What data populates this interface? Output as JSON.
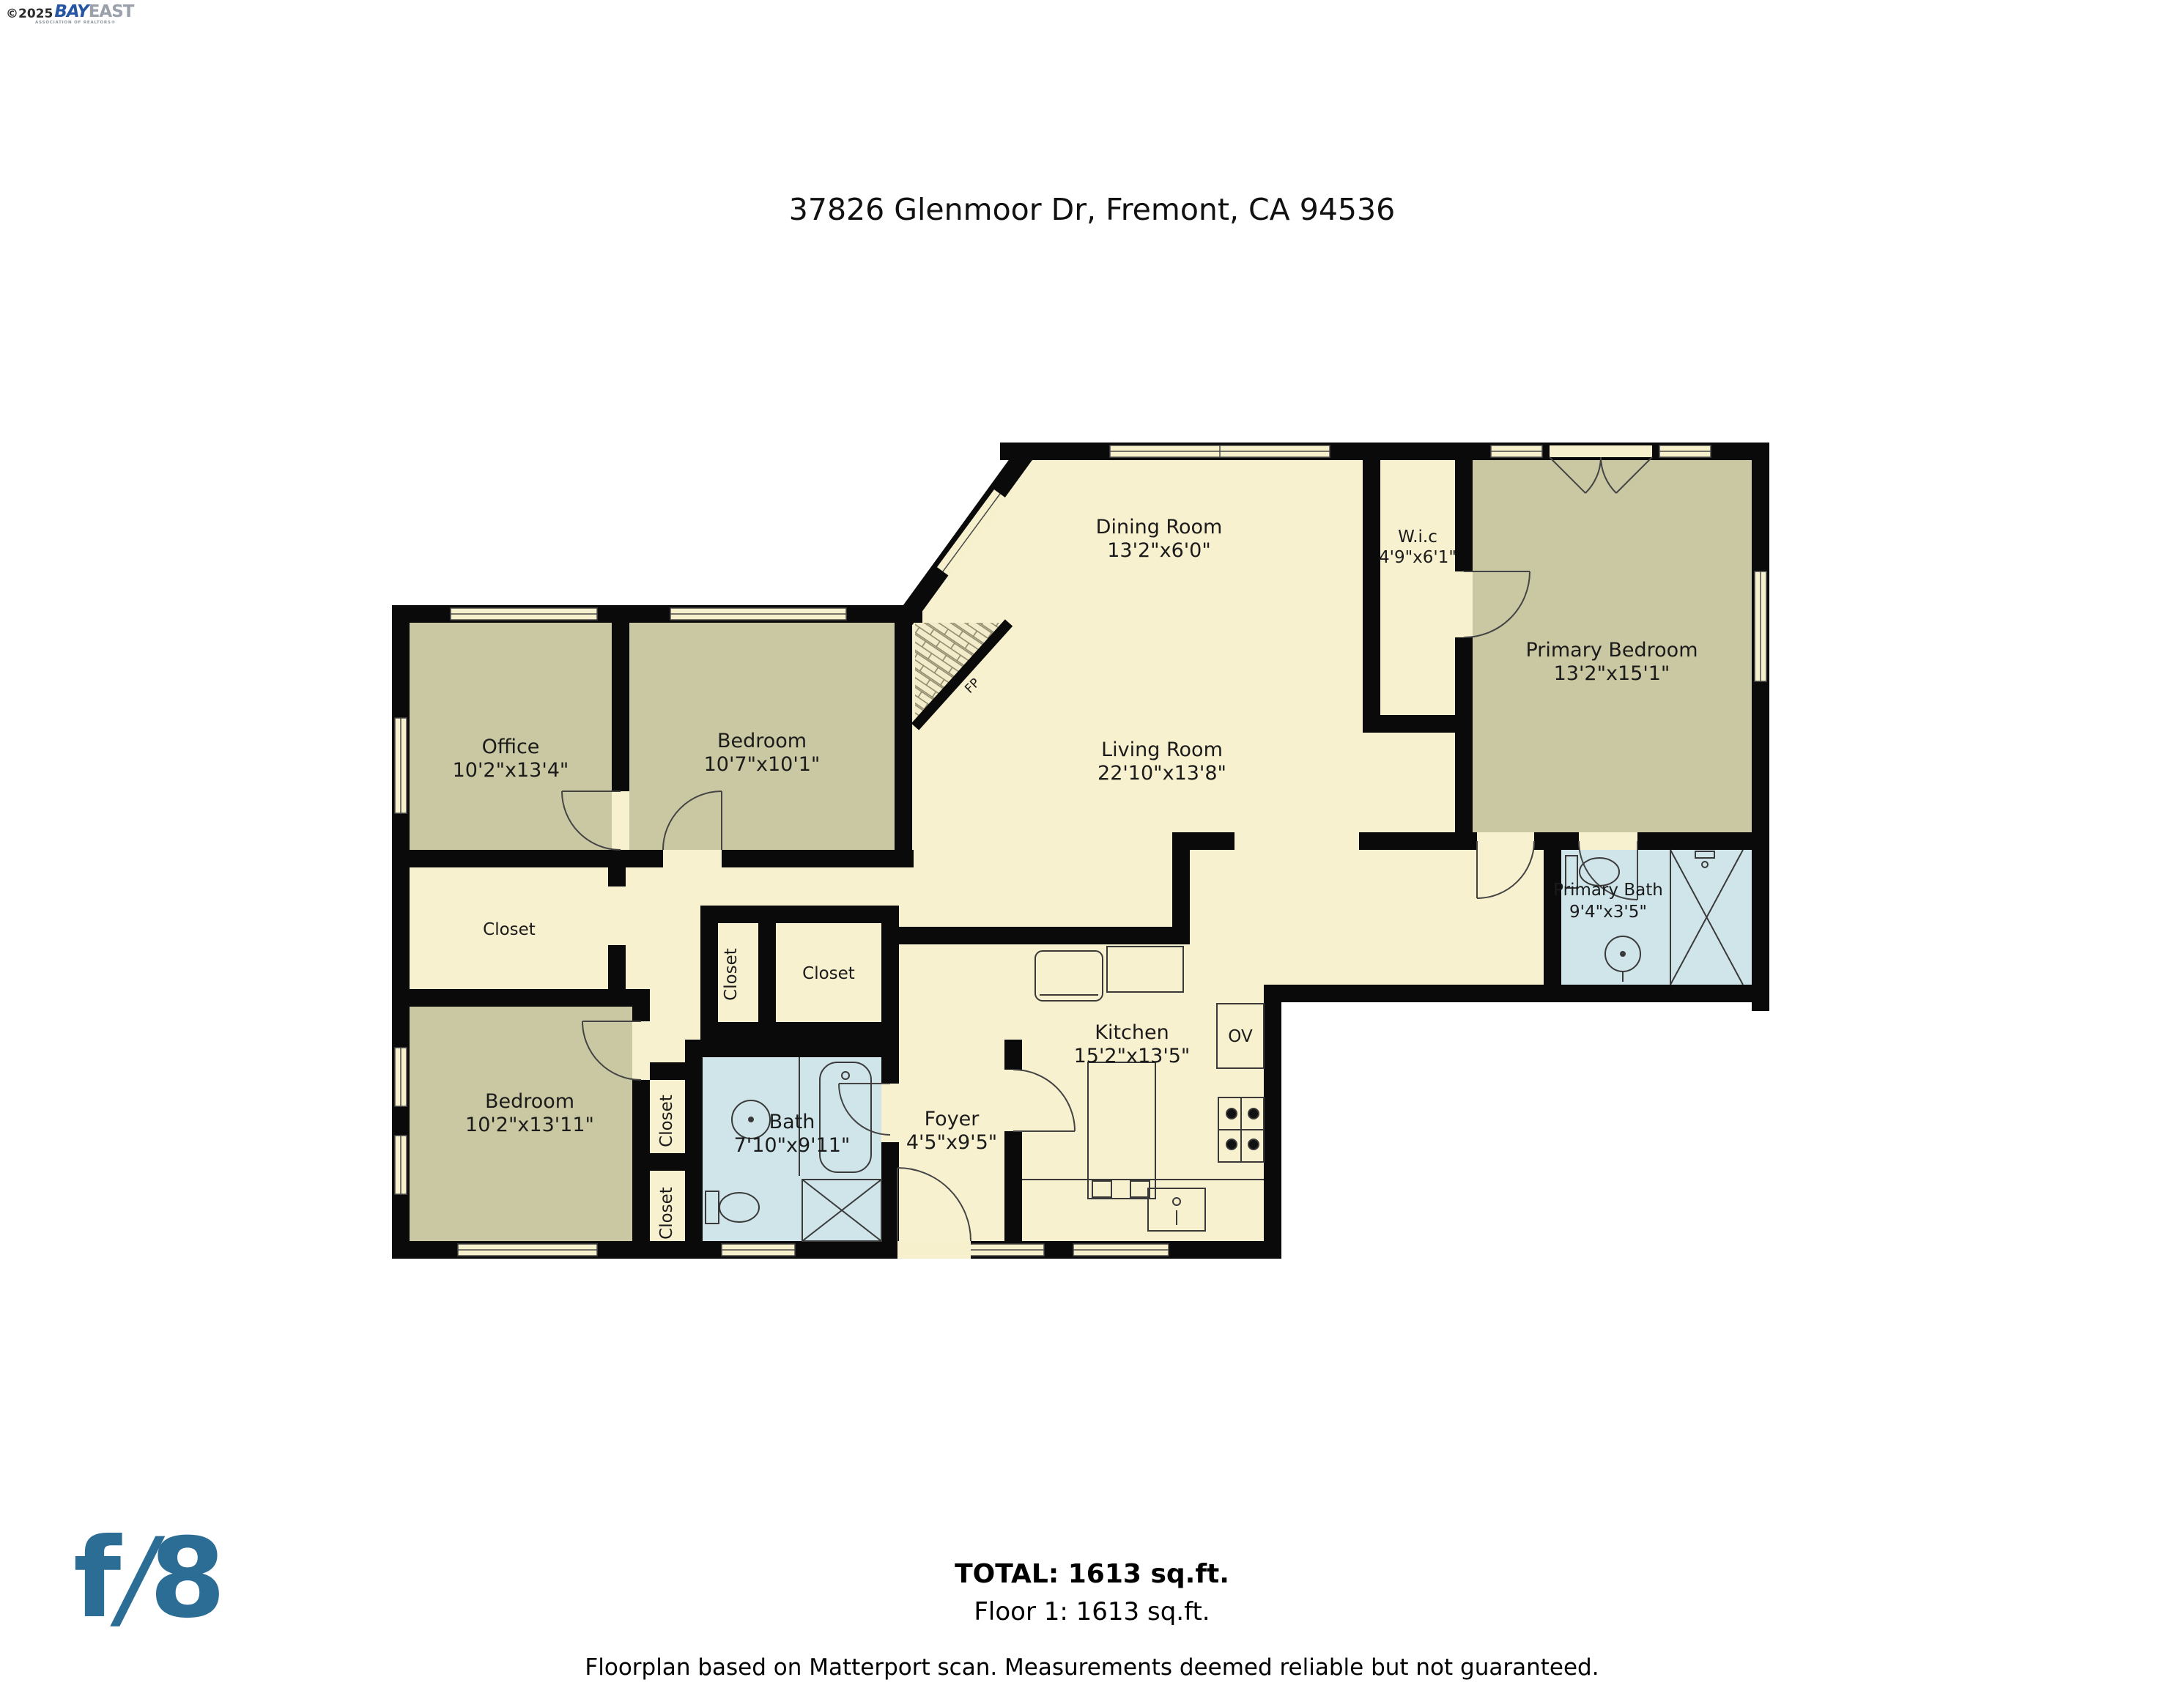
{
  "branding": {
    "copyright": "©2025",
    "bay": "BAY",
    "east": "EAST",
    "association": "ASSOCIATION OF REALTORS®",
    "f8": {
      "f": "f",
      "slash": "/",
      "eight": "8"
    }
  },
  "header": {
    "title": "37826 Glenmoor Dr, Fremont, CA 94536"
  },
  "rooms": {
    "dining": {
      "name": "Dining Room",
      "dims": "13'2\"x6'0\""
    },
    "wic": {
      "name": "W.i.c",
      "dims": "4'9\"x6'1\""
    },
    "primary_bedroom": {
      "name": "Primary Bedroom",
      "dims": "13'2\"x15'1\""
    },
    "office": {
      "name": "Office",
      "dims": "10'2\"x13'4\""
    },
    "bedroom_top": {
      "name": "Bedroom",
      "dims": "10'7\"x10'1\""
    },
    "living_room": {
      "name": "Living Room",
      "dims": "22'10\"x13'8\""
    },
    "primary_bath": {
      "name": "Primary Bath",
      "dims": "9'4\"x3'5\""
    },
    "closet_office": {
      "name": "Closet"
    },
    "closet_hall_small": {
      "name": "Closet"
    },
    "closet_hall_large": {
      "name": "Closet"
    },
    "bedroom_bottom": {
      "name": "Bedroom",
      "dims": "10'2\"x13'11\""
    },
    "closet_bed_upper": {
      "name": "Closet"
    },
    "closet_bed_lower": {
      "name": "Closet"
    },
    "bath": {
      "name": "Bath",
      "dims": "7'10\"x9'11\""
    },
    "foyer": {
      "name": "Foyer",
      "dims": "4'5\"x9'5\""
    },
    "kitchen": {
      "name": "Kitchen",
      "dims": "15'2\"x13'5\""
    },
    "oven": {
      "name": "OV"
    },
    "fireplace": {
      "name": "FP"
    }
  },
  "footer": {
    "total": "TOTAL: 1613 sq.ft.",
    "floor": "Floor 1: 1613 sq.ft.",
    "disclaimer": "Floorplan based on Matterport scan. Measurements deemed reliable but not guaranteed."
  },
  "colors": {
    "wall": "#0a0a0a",
    "floor_cream": "#f8f1cf",
    "room_olive": "#c9c8a2",
    "bath_blue": "#cfe5ea",
    "f8_blue": "#2c6d96",
    "bay_blue": "#2456a4",
    "east_gray": "#9aa1ab"
  }
}
